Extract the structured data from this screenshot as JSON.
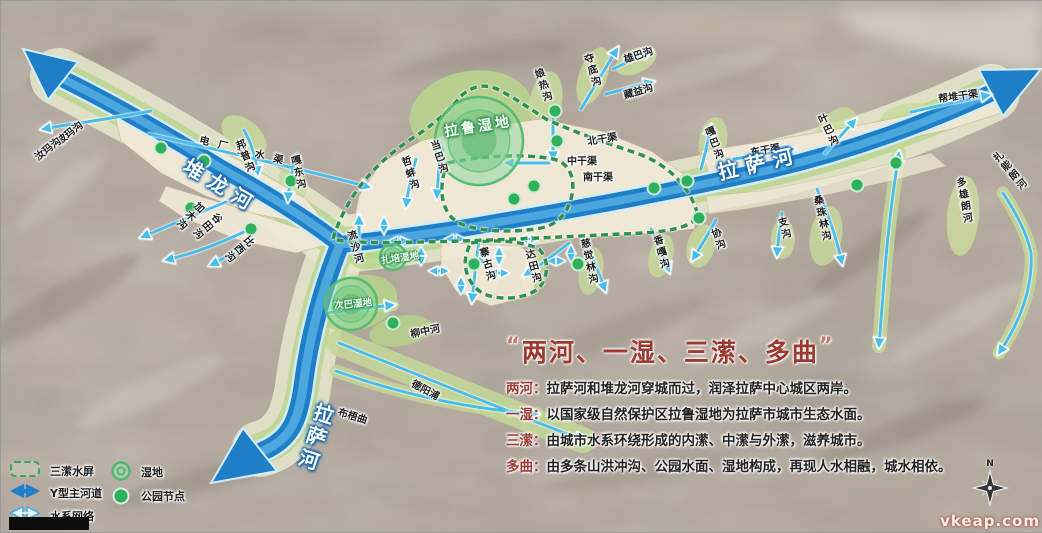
{
  "title_block": {
    "quote_open": "“",
    "title": "两河、一湿、三潆、多曲",
    "quote_close": "”",
    "items": [
      {
        "term": "两河：",
        "desc": "拉萨河和堆龙河穿城而过，润泽拉萨中心城区两岸。"
      },
      {
        "term": "一湿：",
        "desc": "以国家级自然保护区拉鲁湿地为拉萨市城市生态水面。"
      },
      {
        "term": "三潆：",
        "desc": "由城市水系环绕形成的内潆、中潆与外潆，滋养城市。"
      },
      {
        "term": "多曲：",
        "desc": "由多条山洪冲沟、公园水面、湿地构成，再现人水相融，城水相依。"
      }
    ]
  },
  "legend": {
    "items": [
      {
        "icon": "dashed-barrier-icon",
        "label": "三潆水屏"
      },
      {
        "icon": "main-river-arrow-icon",
        "label": "Y型主河道"
      },
      {
        "icon": "water-network-arrow-icon",
        "label": "水系网络"
      },
      {
        "icon": "wetland-circle-icon",
        "label": "湿地"
      },
      {
        "icon": "park-node-icon",
        "label": "公园节点"
      }
    ]
  },
  "compass": {
    "label": "N"
  },
  "watermark": "vkeap.com",
  "colors": {
    "title_red": "#9c3a31",
    "river_blue": "#1f7fc6",
    "barrier_green": "#2f9150",
    "network_cyan": "#49bdea",
    "park_green": "#2fb05a"
  },
  "map": {
    "labels": [
      {
        "t": "波玛沟",
        "x": 68,
        "y": 131,
        "r": -38
      },
      {
        "t": "汝玛沟",
        "x": 46,
        "y": 147,
        "r": -38
      },
      {
        "t": "电厂引水渠",
        "x": 245,
        "y": 149,
        "r": 14,
        "ls": 9
      },
      {
        "t": "邦普沟",
        "x": 243,
        "y": 156,
        "r": -22,
        "v": 1
      },
      {
        "t": "嘎东沟",
        "x": 296,
        "y": 172,
        "r": -12,
        "v": 1
      },
      {
        "t": "堆龙河",
        "x": 221,
        "y": 184,
        "r": 31,
        "cls": "riv"
      },
      {
        "t": "加木沟",
        "x": 188,
        "y": 214,
        "r": 45,
        "v": 1
      },
      {
        "t": "谷田沟",
        "x": 205,
        "y": 224,
        "r": 50,
        "v": 1
      },
      {
        "t": "比西沟",
        "x": 237,
        "y": 247,
        "r": 50,
        "v": 1
      },
      {
        "t": "流沙河",
        "x": 353,
        "y": 247,
        "r": -16,
        "v": 1
      },
      {
        "t": "哲蚌沟",
        "x": 408,
        "y": 173,
        "r": -18,
        "v": 1
      },
      {
        "t": "当巴沟",
        "x": 437,
        "y": 157,
        "r": -18,
        "v": 1
      },
      {
        "t": "拉鲁湿地",
        "x": 477,
        "y": 125,
        "r": -9,
        "cls": "wb"
      },
      {
        "t": "娘热沟",
        "x": 541,
        "y": 85,
        "r": -18,
        "v": 1
      },
      {
        "t": "夺底沟",
        "x": 590,
        "y": 70,
        "r": -17,
        "v": 1
      },
      {
        "t": "雄巴沟",
        "x": 637,
        "y": 53,
        "r": -18
      },
      {
        "t": "藏益沟",
        "x": 637,
        "y": 89,
        "r": -16
      },
      {
        "t": "北干渠",
        "x": 601,
        "y": 137,
        "r": -10
      },
      {
        "t": "中干渠",
        "x": 581,
        "y": 159,
        "r": 0
      },
      {
        "t": "南干渠",
        "x": 597,
        "y": 175,
        "r": 0
      },
      {
        "t": "嘎巴沟",
        "x": 712,
        "y": 143,
        "r": -20,
        "v": 1
      },
      {
        "t": "东干渠",
        "x": 764,
        "y": 148,
        "r": -10
      },
      {
        "t": "叶巴沟",
        "x": 826,
        "y": 130,
        "r": -25,
        "v": 1
      },
      {
        "t": "帮堆干渠",
        "x": 957,
        "y": 94,
        "r": -8
      },
      {
        "t": "拉萨河",
        "x": 758,
        "y": 161,
        "r": -13,
        "cls": "riv"
      },
      {
        "t": "扎能朗河",
        "x": 1008,
        "y": 171,
        "r": -40,
        "v": 1
      },
      {
        "t": "多雄朗河",
        "x": 962,
        "y": 200,
        "r": -10,
        "v": 1
      },
      {
        "t": "协沟",
        "x": 716,
        "y": 239,
        "r": -20,
        "v": 1
      },
      {
        "t": "支沟",
        "x": 782,
        "y": 228,
        "r": -15,
        "v": 1
      },
      {
        "t": "桑珠林沟",
        "x": 820,
        "y": 218,
        "r": -12,
        "v": 1
      },
      {
        "t": "香嘎沟",
        "x": 659,
        "y": 252,
        "r": -15,
        "v": 1
      },
      {
        "t": "慈觉林沟",
        "x": 587,
        "y": 261,
        "r": -12,
        "v": 1
      },
      {
        "t": "达田沟",
        "x": 531,
        "y": 266,
        "r": -15,
        "v": 1
      },
      {
        "t": "寨古沟",
        "x": 485,
        "y": 264,
        "r": -15,
        "v": 1
      },
      {
        "t": "扎培湿地",
        "x": 399,
        "y": 256,
        "r": -8,
        "cls": "ws"
      },
      {
        "t": "次巴湿地",
        "x": 352,
        "y": 302,
        "r": -5,
        "cls": "ws"
      },
      {
        "t": "柳中河",
        "x": 424,
        "y": 329,
        "r": -12
      },
      {
        "t": "德阳浦",
        "x": 425,
        "y": 388,
        "r": 28
      },
      {
        "t": "布梧曲",
        "x": 352,
        "y": 414,
        "r": 17
      },
      {
        "t": "拉萨河",
        "x": 314,
        "y": 437,
        "r": 18,
        "v": 1,
        "cls": "riv"
      }
    ],
    "park_nodes": [
      [
        160,
        147
      ],
      [
        203,
        160
      ],
      [
        290,
        180
      ],
      [
        190,
        207
      ],
      [
        250,
        228
      ],
      [
        554,
        110
      ],
      [
        556,
        140
      ],
      [
        533,
        185
      ],
      [
        513,
        198
      ],
      [
        653,
        187
      ],
      [
        686,
        180
      ],
      [
        698,
        217
      ],
      [
        856,
        184
      ],
      [
        895,
        162
      ],
      [
        473,
        263
      ],
      [
        577,
        263
      ],
      [
        392,
        322
      ]
    ],
    "wetlands": [
      {
        "x": 478,
        "y": 140,
        "r": 44
      },
      {
        "x": 392,
        "y": 256,
        "r": 13
      },
      {
        "x": 350,
        "y": 303,
        "r": 26
      }
    ]
  }
}
